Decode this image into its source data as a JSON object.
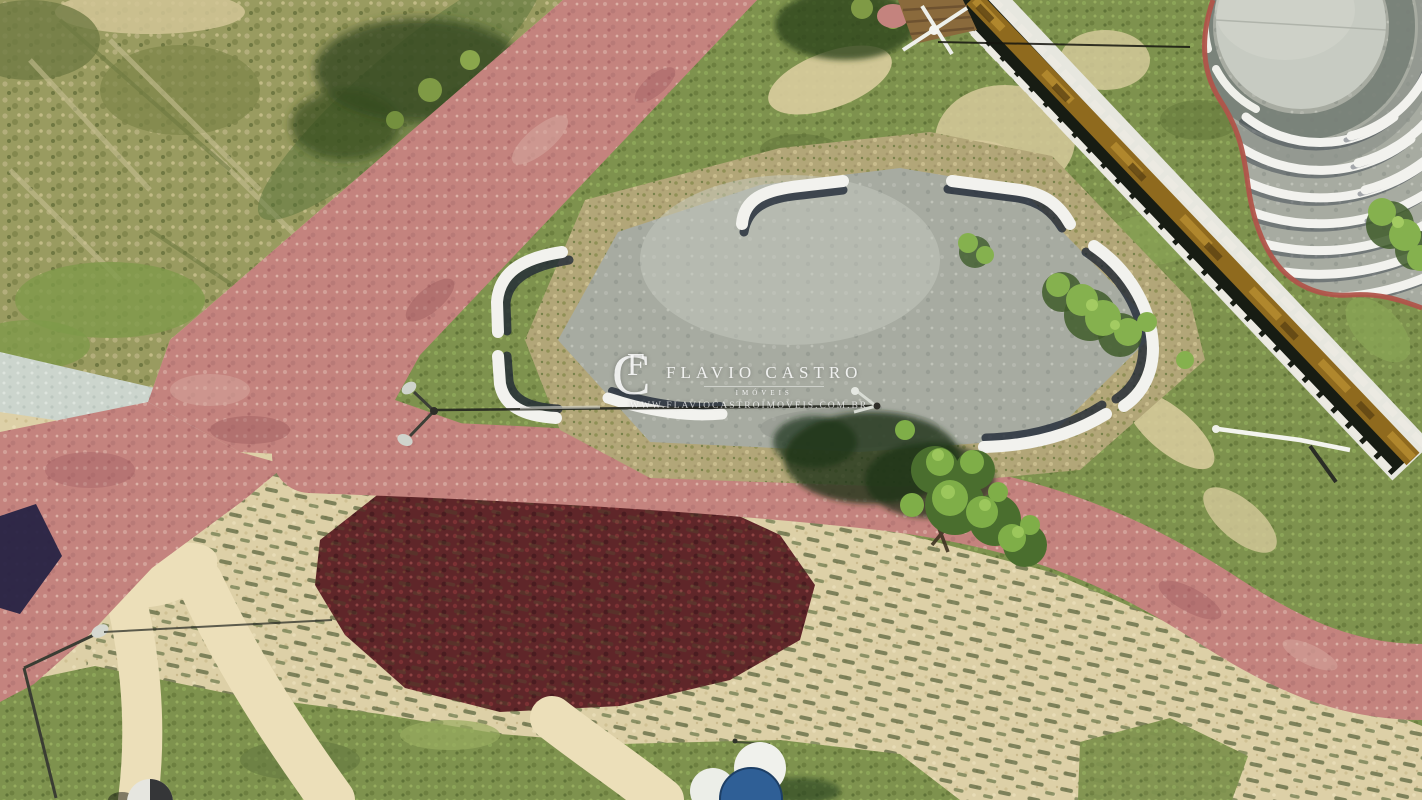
{
  "watermark": {
    "monogram_c": "C",
    "monogram_f": "F",
    "name": "FLAVIO CASTRO",
    "tagline": "IMÓVEIS",
    "website": "WWW.FLAVIOCASTROIMOVEIS.COM.BR"
  },
  "colors": {
    "path_pink": "#c4837e",
    "path_pink_light": "#d6a89e",
    "path_pink_dark": "#9e5a5e",
    "grass_green": "#7e924e",
    "grass_bright": "#8fa75a",
    "scrub_olive": "#999b60",
    "sand": "#ddd0a7",
    "sand_bright": "#ecdfb9",
    "gravel_tan": "#b2a678",
    "plaza_gray": "#a7aba1",
    "bench_white": "#f2f2ee",
    "bench_shadow": "#1f2836",
    "stone_white": "#e7e7df",
    "water_amber": "#8f6a1e",
    "channel_shadow": "#171c13",
    "brick_red": "#b0544a",
    "maroon_veg": "#5f2629",
    "navy_mat": "#272345",
    "table_blue": "#2f5f96",
    "pale_band": "#ccd5cd",
    "deck_wood": "#8a6a3c"
  }
}
